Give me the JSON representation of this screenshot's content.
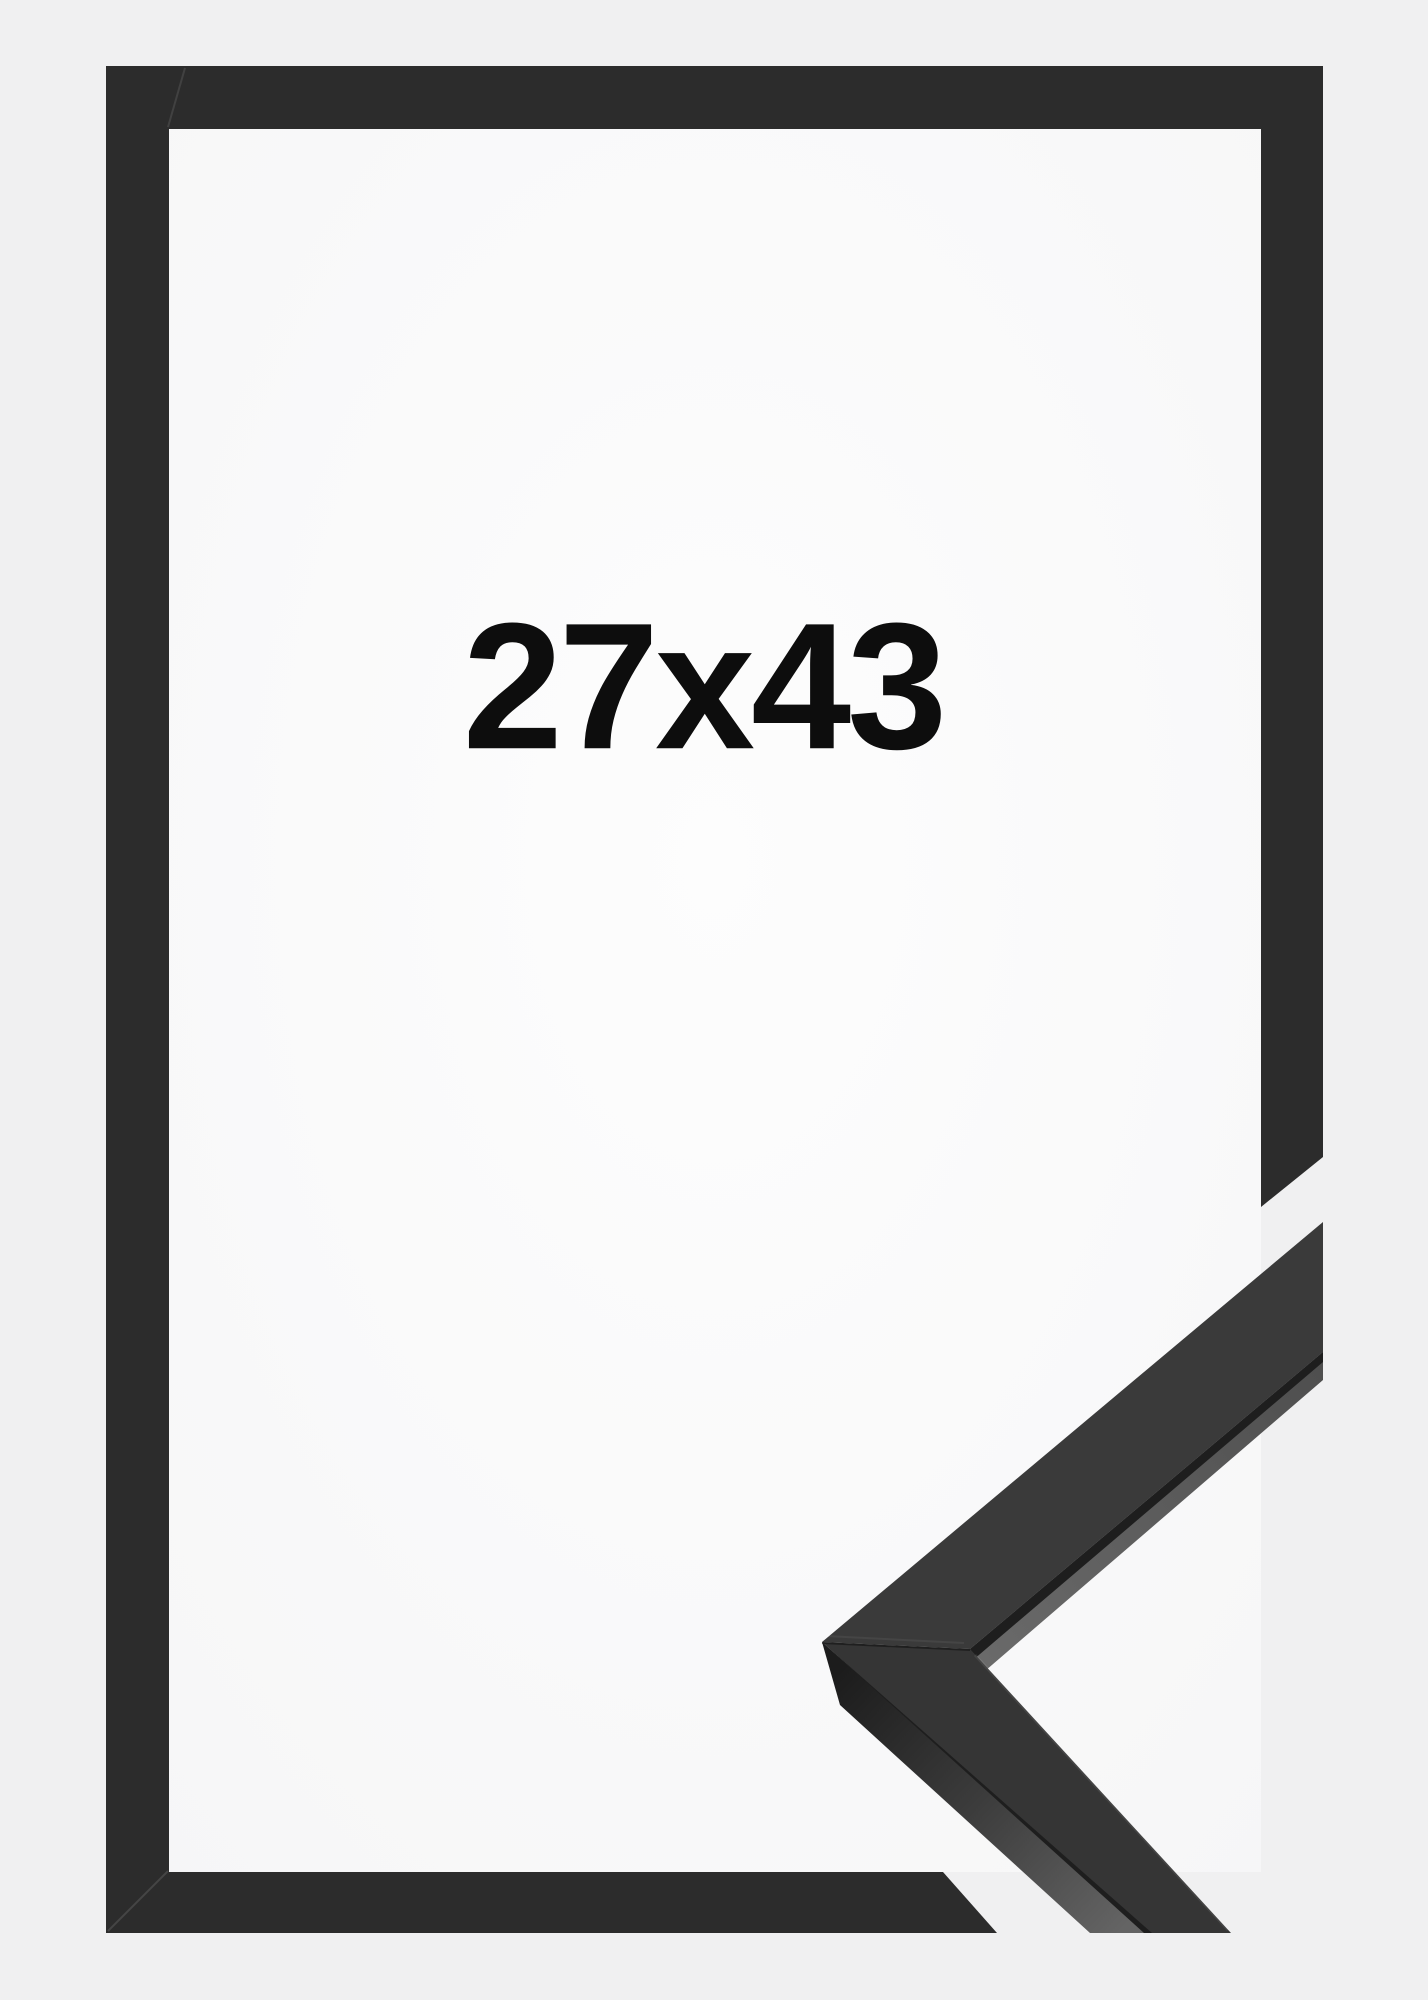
{
  "image": {
    "size_label": "27x43",
    "colors": {
      "background": "#f0f0f1",
      "inner_area_center": "#fdfdfd",
      "inner_area_edge": "#f6f6f7",
      "frame": "#2c2c2c",
      "detail_face_upper": "#3a3a3a",
      "detail_face_lower": "#353535",
      "detail_seam": "#1e1e1e",
      "strip_start": "#6a6a6a",
      "strip_end": "#4e4e4e",
      "band_start": "#1c1c1c",
      "band_mid": "#3c3c3c",
      "band_end": "#646464",
      "label_text": "#0d0d0d"
    }
  }
}
